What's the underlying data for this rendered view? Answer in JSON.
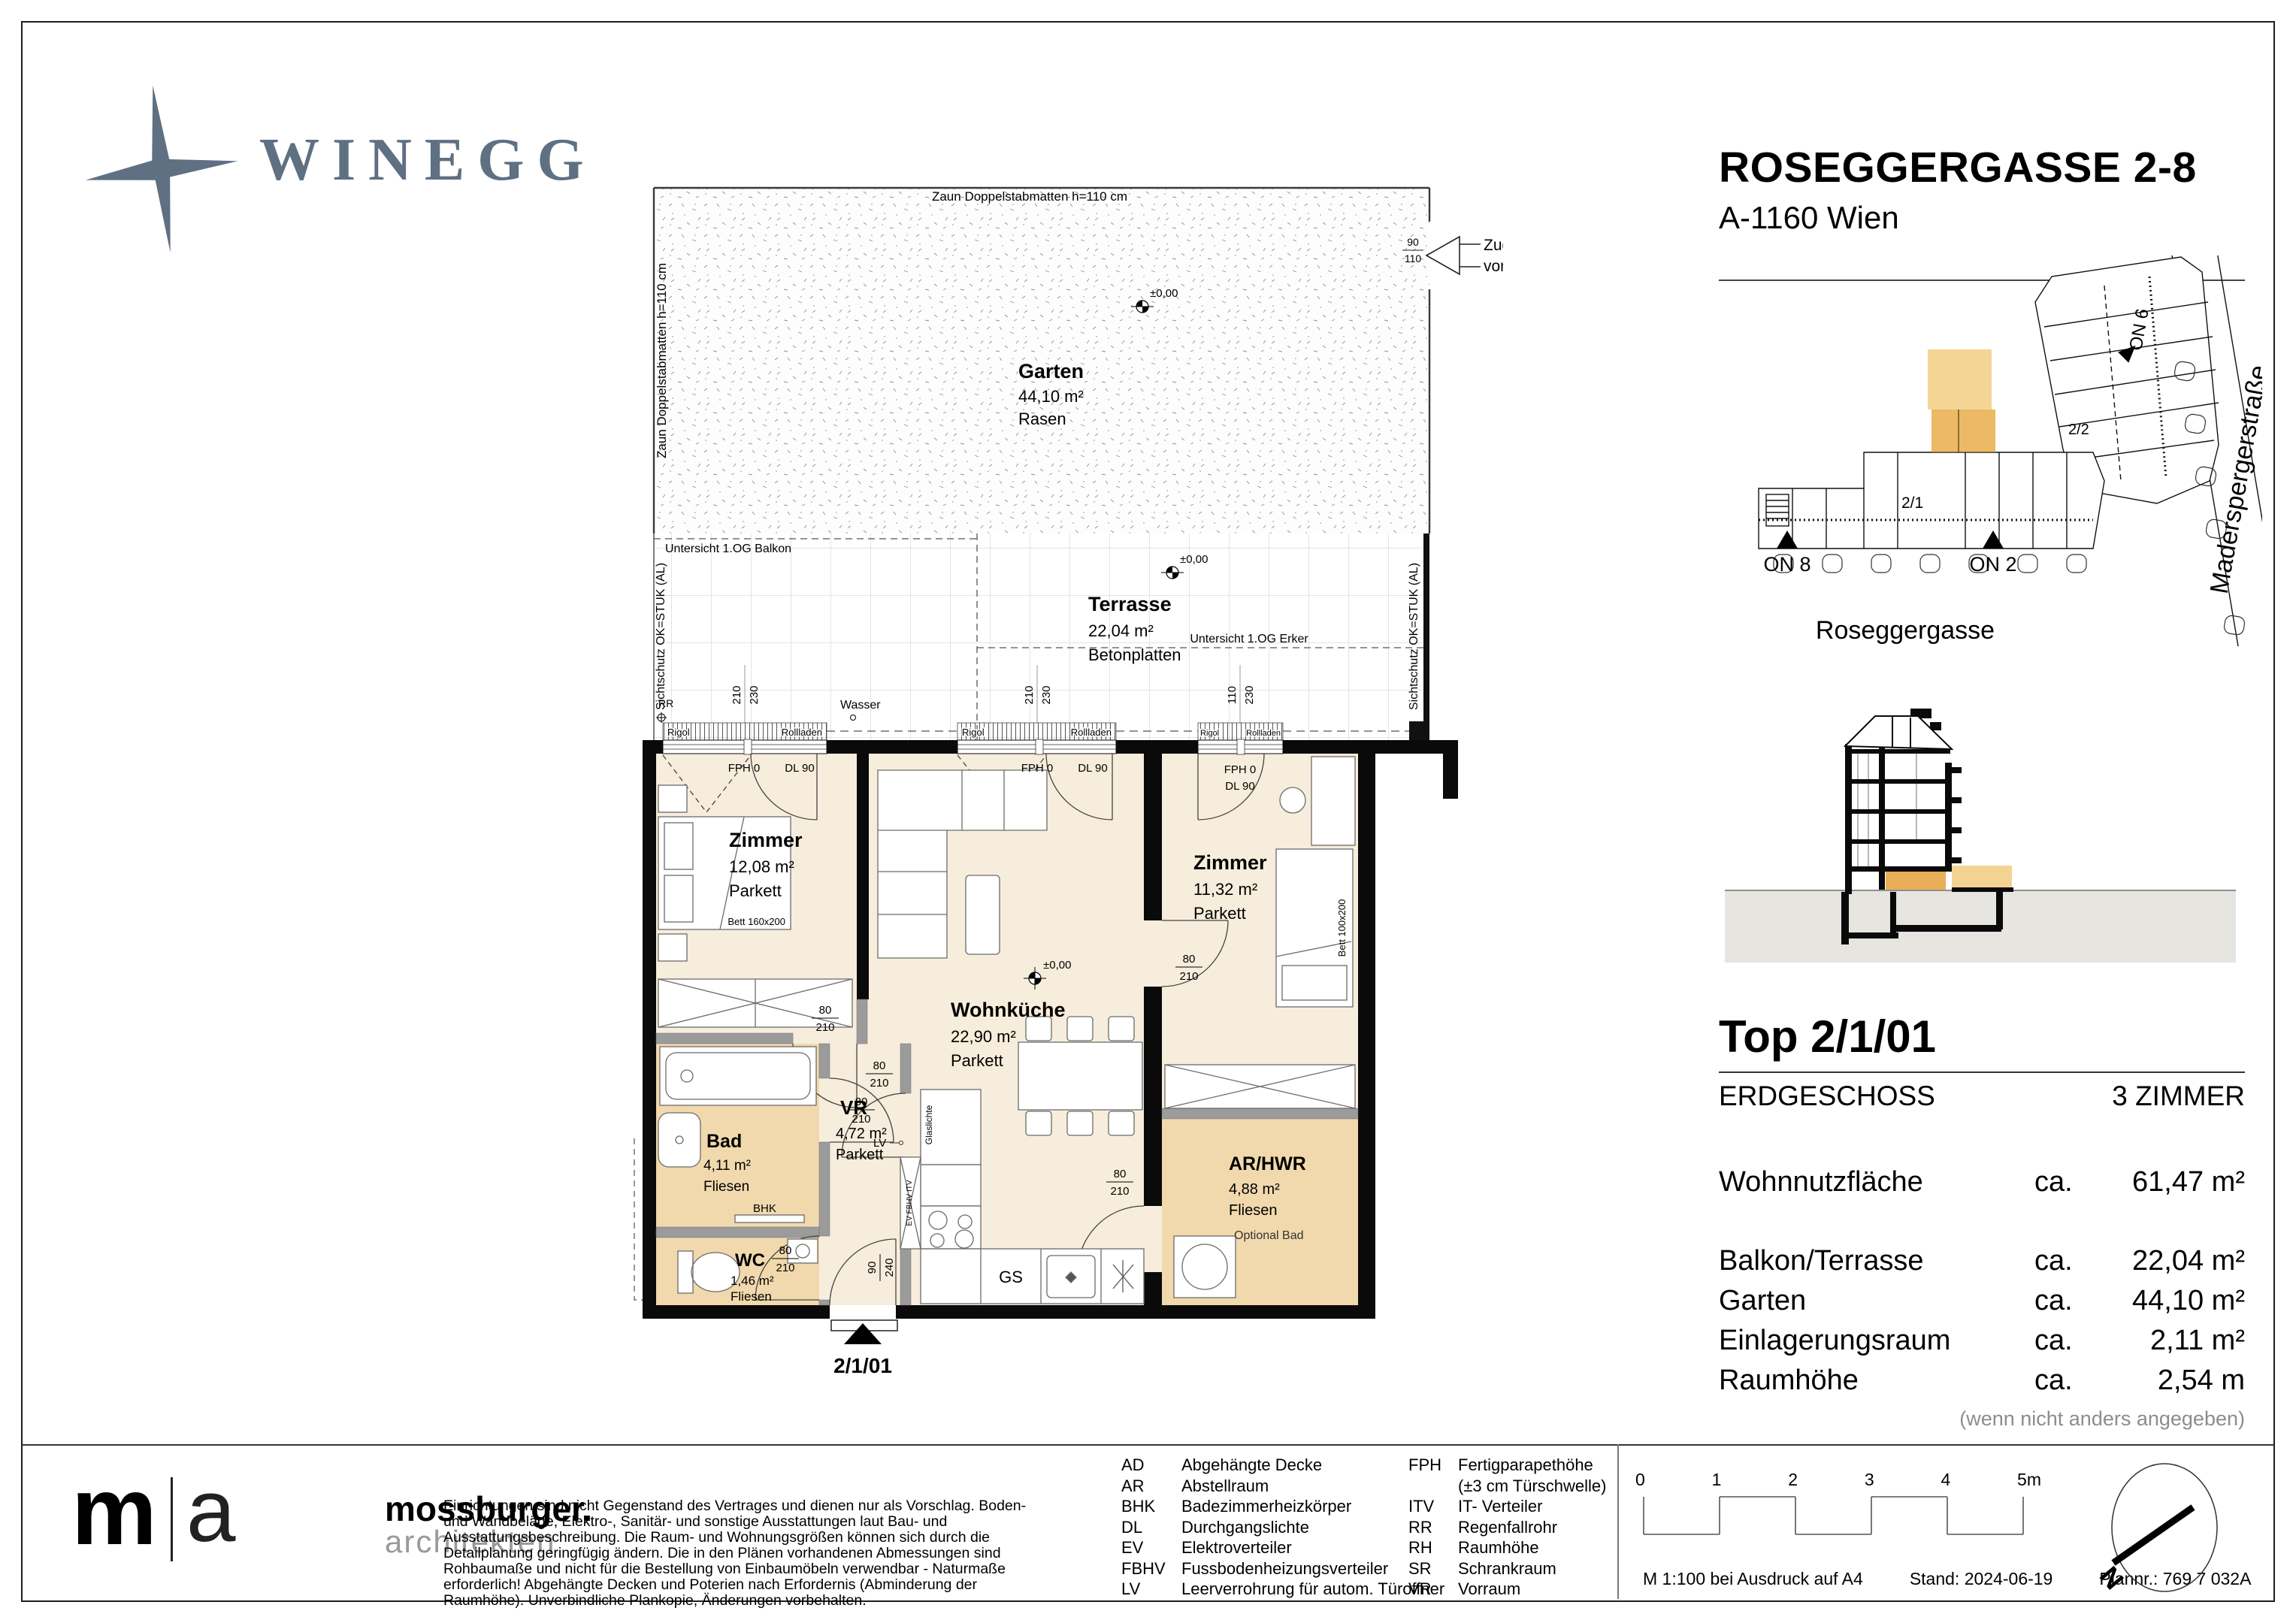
{
  "header": {
    "logo": "WINEGG",
    "project": "ROSEGGERGASSE 2-8",
    "city": "A-1160 Wien"
  },
  "site": {
    "street_main": "Roseggergasse",
    "street_side": "Maderspergerstraße",
    "on8": "ON 8",
    "on2": "ON 2",
    "on6": "ON 6",
    "u21": "2/1",
    "u22": "2/2"
  },
  "info": {
    "title": "Top 2/1/01",
    "floor": "ERDGESCHOSS",
    "rooms": "3 ZIMMER",
    "ca": "ca.",
    "rows": [
      {
        "label": "Wohnnutzfläche",
        "value": "61,47 m²"
      },
      {
        "label": "Balkon/Terrasse",
        "value": "22,04 m²"
      },
      {
        "label": "Garten",
        "value": "44,10 m²"
      },
      {
        "label": "Einlagerungsraum",
        "value": "2,11 m²"
      },
      {
        "label": "Raumhöhe",
        "value": "2,54 m"
      }
    ],
    "note": "(wenn nicht anders angegeben)"
  },
  "plan": {
    "garden": {
      "title": "Garten",
      "area": "44,10 m²",
      "surface": "Rasen",
      "fence": "Zaun Doppelstabmatten h=110 cm",
      "access1": "Zugang Garten",
      "access2": "vom Innenhof",
      "dim_w": "90",
      "dim_h": "110"
    },
    "terrace": {
      "title": "Terrasse",
      "area": "22,04 m²",
      "surface": "Betonplatten",
      "balkon": "Untersicht 1.OG Balkon",
      "erker": "Untersicht 1.OG Erker",
      "sicht": "Sichtschutz OK=STUK (AL)",
      "rr": "RR",
      "wasser": "Wasser"
    },
    "dims": {
      "d210": "210",
      "d230": "230",
      "d110": "110",
      "d80": "80",
      "d90": "90",
      "d240": "240"
    },
    "win": {
      "rigol": "Rigol",
      "rollladen": "Rollladen",
      "fph": "FPH 0",
      "dl": "DL 90"
    },
    "z1": {
      "title": "Zimmer",
      "area": "12,08 m²",
      "surface": "Parkett",
      "bed": "Bett 160x200"
    },
    "z2": {
      "title": "Zimmer",
      "area": "11,32 m²",
      "surface": "Parkett",
      "bed": "Bett 100x200"
    },
    "wk": {
      "title": "Wohnküche",
      "area": "22,90 m²",
      "surface": "Parkett"
    },
    "vr": {
      "title": "VR",
      "area": "4,72 m²",
      "surface": "Parkett"
    },
    "bad": {
      "title": "Bad",
      "area": "4,11 m²",
      "surface": "Fliesen",
      "bhk": "BHK"
    },
    "wc": {
      "title": "WC",
      "area": "1,46 m²",
      "surface": "Fliesen"
    },
    "ar": {
      "title": "AR/HWR",
      "area": "4,88 m²",
      "surface": "Fliesen",
      "note": "Optional Bad"
    },
    "misc": {
      "gs": "GS",
      "lv": "LV",
      "glas": "Glaslichte",
      "shaft": "EV FBHV ITV",
      "unit": "2/1/01",
      "level": "±0,00"
    }
  },
  "footer": {
    "ma_m": "m",
    "ma_a": "a",
    "name": "mossburger.",
    "sub": "architekten",
    "disclaimer": "Einrichtungen sind nicht Gegenstand des Vertrages und dienen nur als Vorschlag. Boden- und Wandbeläge, Elektro-, Sanitär- und sonstige Ausstattungen laut Bau- und Ausstattungsbeschreibung. Die Raum- und Wohnungsgrößen können sich durch die Detailplanung geringfügig ändern. Die in den Plänen vorhandenen Abmessungen sind Rohbaumaße und nicht für die Bestellung von Einbaumöbeln verwendbar - Naturmaße erforderlich! Abgehängte Decken und Poterien nach Erfordernis (Abminderung der Raumhöhe). Unverbindliche Plankopie, Änderungen vorbehalten.",
    "legend1": [
      {
        "abbr": "AD",
        "text": "Abgehängte Decke"
      },
      {
        "abbr": "AR",
        "text": "Abstellraum"
      },
      {
        "abbr": "BHK",
        "text": "Badezimmerheizkörper"
      },
      {
        "abbr": "DL",
        "text": "Durchgangslichte"
      },
      {
        "abbr": "EV",
        "text": "Elektroverteiler"
      },
      {
        "abbr": "FBHV",
        "text": "Fussbodenheizungsverteiler"
      },
      {
        "abbr": "LV",
        "text": "Leerverrohrung für autom. Türoffner"
      }
    ],
    "legend2": [
      {
        "abbr": "FPH",
        "text": "Fertigparapethöhe"
      },
      {
        "abbr": "",
        "text": "(±3 cm Türschwelle)"
      },
      {
        "abbr": "ITV",
        "text": "IT- Verteiler"
      },
      {
        "abbr": "RR",
        "text": "Regenfallrohr"
      },
      {
        "abbr": "RH",
        "text": "Raumhöhe"
      },
      {
        "abbr": "SR",
        "text": "Schrankraum"
      },
      {
        "abbr": "VR",
        "text": "Vorraum"
      }
    ],
    "scale": [
      "0",
      "1",
      "2",
      "3",
      "4",
      "5m"
    ],
    "info1": "M 1:100 bei Ausdruck auf A4",
    "info2": "Stand: 2024-06-19",
    "info3": "Plannr.: 769 7 032A",
    "north": "N"
  }
}
